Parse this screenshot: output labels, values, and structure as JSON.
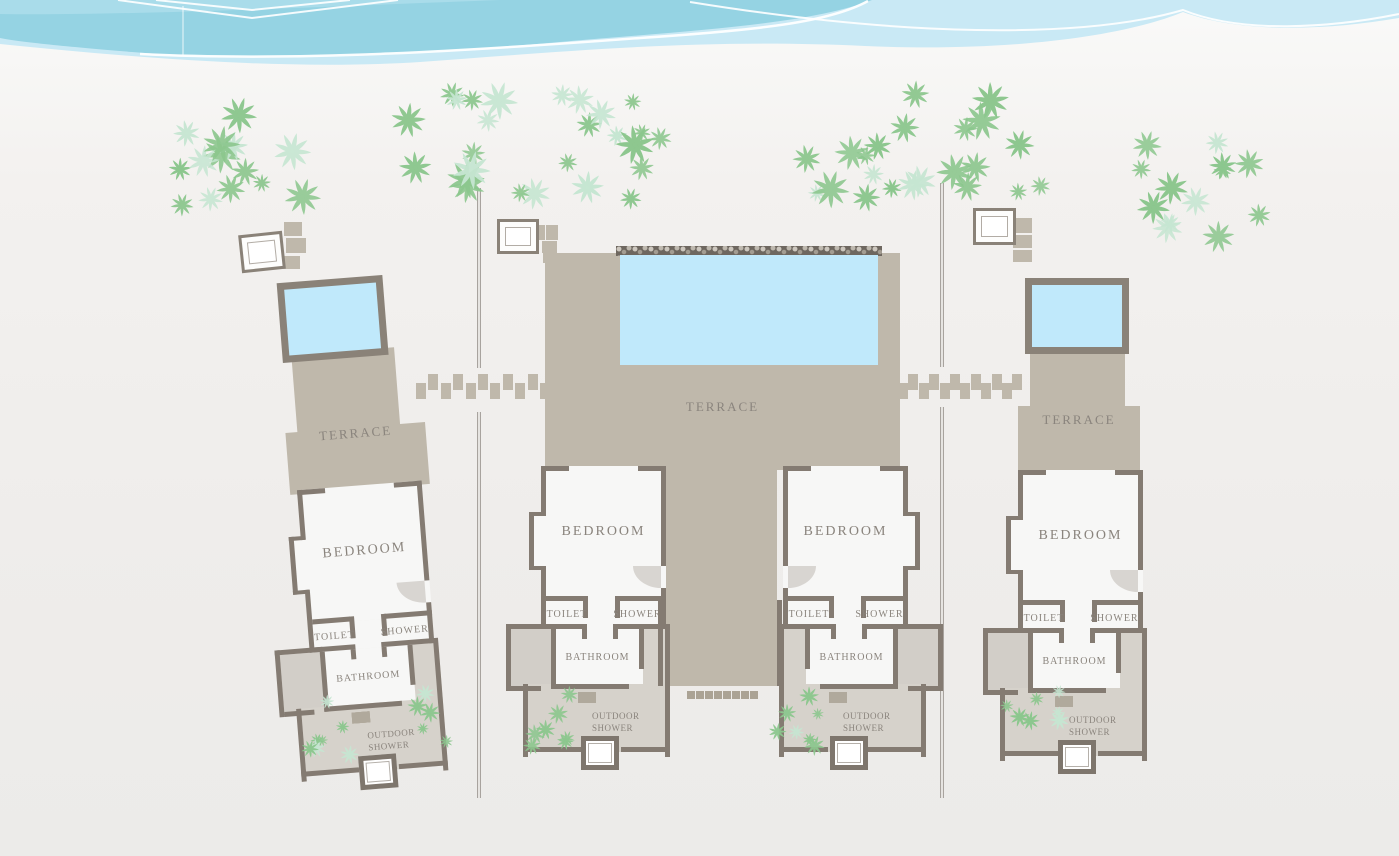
{
  "villas": [
    {
      "name": "left-villa",
      "terrace_label": "TERRACE",
      "units": [
        {
          "bedroom_label": "BEDROOM",
          "toilet_label": "TOILET",
          "shower_label": "SHOWER",
          "bathroom_label": "BATHROOM",
          "outdoor_shower_label": "OUTDOOR SHOWER"
        }
      ]
    },
    {
      "name": "center-villa",
      "terrace_label": "TERRACE",
      "units": [
        {
          "bedroom_label": "BEDROOM",
          "toilet_label": "TOILET",
          "shower_label": "SHOWER",
          "bathroom_label": "BATHROOM",
          "outdoor_shower_label": "OUTDOOR SHOWER"
        },
        {
          "bedroom_label": "BEDROOM",
          "toilet_label": "TOILET",
          "shower_label": "SHOWER",
          "bathroom_label": "BATHROOM",
          "outdoor_shower_label": "OUTDOOR SHOWER"
        }
      ]
    },
    {
      "name": "right-villa",
      "terrace_label": "TERRACE",
      "units": [
        {
          "bedroom_label": "BEDROOM",
          "toilet_label": "TOILET",
          "shower_label": "SHOWER",
          "bathroom_label": "BATHROOM",
          "outdoor_shower_label": "OUTDOOR SHOWER"
        }
      ]
    }
  ],
  "colors": {
    "sea_mid": "#95d3e3",
    "sea_light": "#c9e9f5",
    "sea_pale": "#a9dcea",
    "pool": "#c0e9fb",
    "pool_wall": "#8a8278",
    "terrace": "#bfb8ab",
    "wall": "#847b72",
    "room": "#f7f7f6",
    "yard": "#d6d2cb",
    "annex": "#d2cec8",
    "steps": "#b0a99c",
    "fence": "#a8a39e",
    "text": "#8a847d",
    "palm": "#8cc78e",
    "palm_pale": "#c6e6d2",
    "arc": "#d8d5d1",
    "tub_border": "#7e766d"
  }
}
